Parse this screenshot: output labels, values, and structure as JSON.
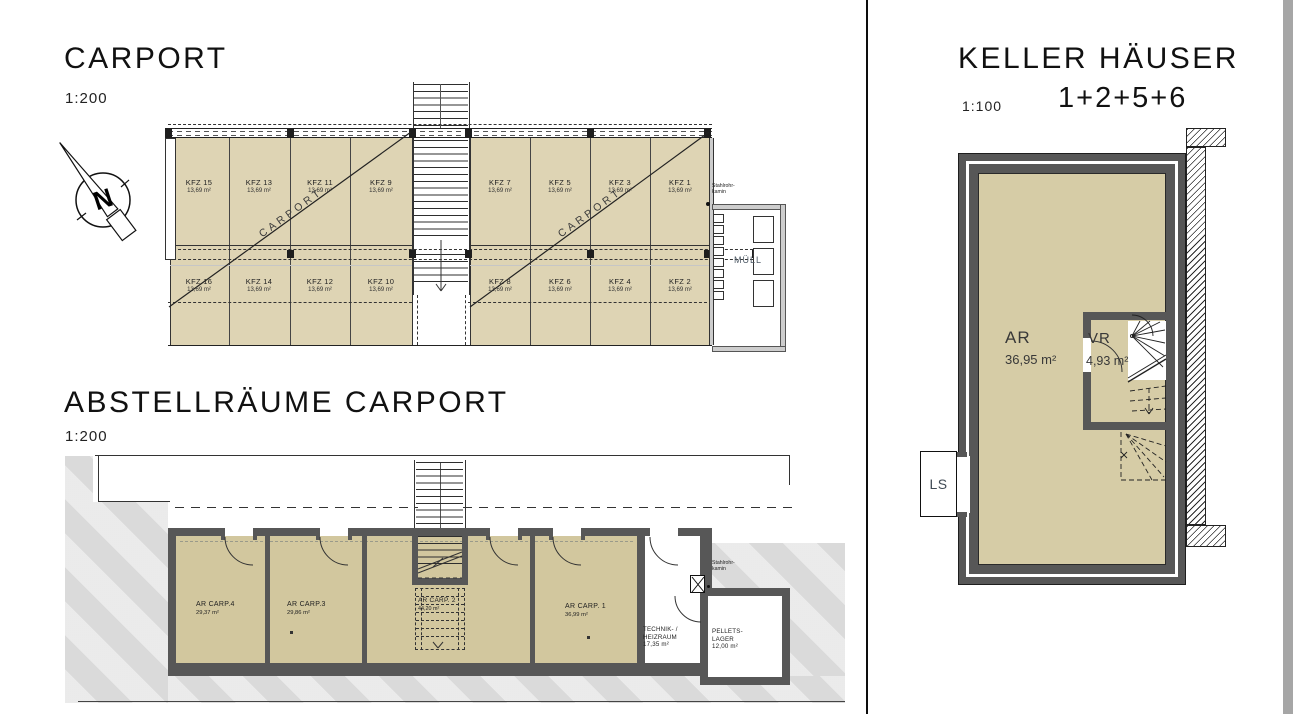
{
  "colors": {
    "tan_carport": "#ded4b4",
    "tan_abstell": "#d2c79e",
    "tan_keller": "#d6cca6",
    "wall_grey": "#575757",
    "terrain_grey": "#dadada",
    "muell_wall_grey": "#cdcdcd",
    "label_slate": "#4e5a66",
    "page_edge_grey": "#a6a6a6"
  },
  "compass": {
    "north": "N"
  },
  "carport": {
    "title": "CARPORT",
    "scale": "1:200",
    "roof_label": "CARPORT",
    "stalls_top_left": [
      {
        "id": "KFZ 15",
        "area": "13,69 m²"
      },
      {
        "id": "KFZ 13",
        "area": "13,69 m²"
      },
      {
        "id": "KFZ 11",
        "area": "13,69 m²"
      },
      {
        "id": "KFZ 9",
        "area": "13,69 m²"
      }
    ],
    "stalls_bottom_left": [
      {
        "id": "KFZ 16",
        "area": "13,69 m²"
      },
      {
        "id": "KFZ 14",
        "area": "13,69 m²"
      },
      {
        "id": "KFZ 12",
        "area": "13,69 m²"
      },
      {
        "id": "KFZ 10",
        "area": "13,69 m²"
      }
    ],
    "stalls_top_right": [
      {
        "id": "KFZ 7",
        "area": "13,69 m²"
      },
      {
        "id": "KFZ 5",
        "area": "13,69 m²"
      },
      {
        "id": "KFZ 3",
        "area": "13,69 m²"
      },
      {
        "id": "KFZ 1",
        "area": "13,69 m²"
      }
    ],
    "stalls_bottom_right": [
      {
        "id": "KFZ 8",
        "area": "13,69 m²"
      },
      {
        "id": "KFZ 6",
        "area": "13,69 m²"
      },
      {
        "id": "KFZ 4",
        "area": "13,69 m²"
      },
      {
        "id": "KFZ 2",
        "area": "13,69 m²"
      }
    ],
    "muell": "MÜLL",
    "kamin": {
      "line1": "Stahlrohr-",
      "line2": "kamin"
    }
  },
  "abstellraeume": {
    "title": "ABSTELLRÄUME CARPORT",
    "scale": "1:200",
    "rooms": [
      {
        "name": "AR CARP.4",
        "area": "29,37 m²"
      },
      {
        "name": "AR CARP.3",
        "area": "29,86 m²"
      },
      {
        "name": "AR CARP. 2",
        "area": "44,20 m²"
      },
      {
        "name": "AR CARP. 1",
        "area": "36,99 m²"
      }
    ],
    "technik": {
      "line1": "TECHNIK- /",
      "line2": "HEIZRAUM",
      "area": "17,35 m²"
    },
    "pellets": {
      "line1": "PELLETS-",
      "line2": "LAGER",
      "area": "12,00 m²"
    },
    "kamin": {
      "line1": "Stahlrohr-",
      "line2": "kamin"
    }
  },
  "keller": {
    "title": "KELLER HÄUSER",
    "scale": "1:100",
    "houses": "1+2+5+6",
    "ar": {
      "name": "AR",
      "area": "36,95 m²"
    },
    "vr": {
      "name": "VR",
      "area": "4,93 m²"
    },
    "ls": "LS"
  }
}
